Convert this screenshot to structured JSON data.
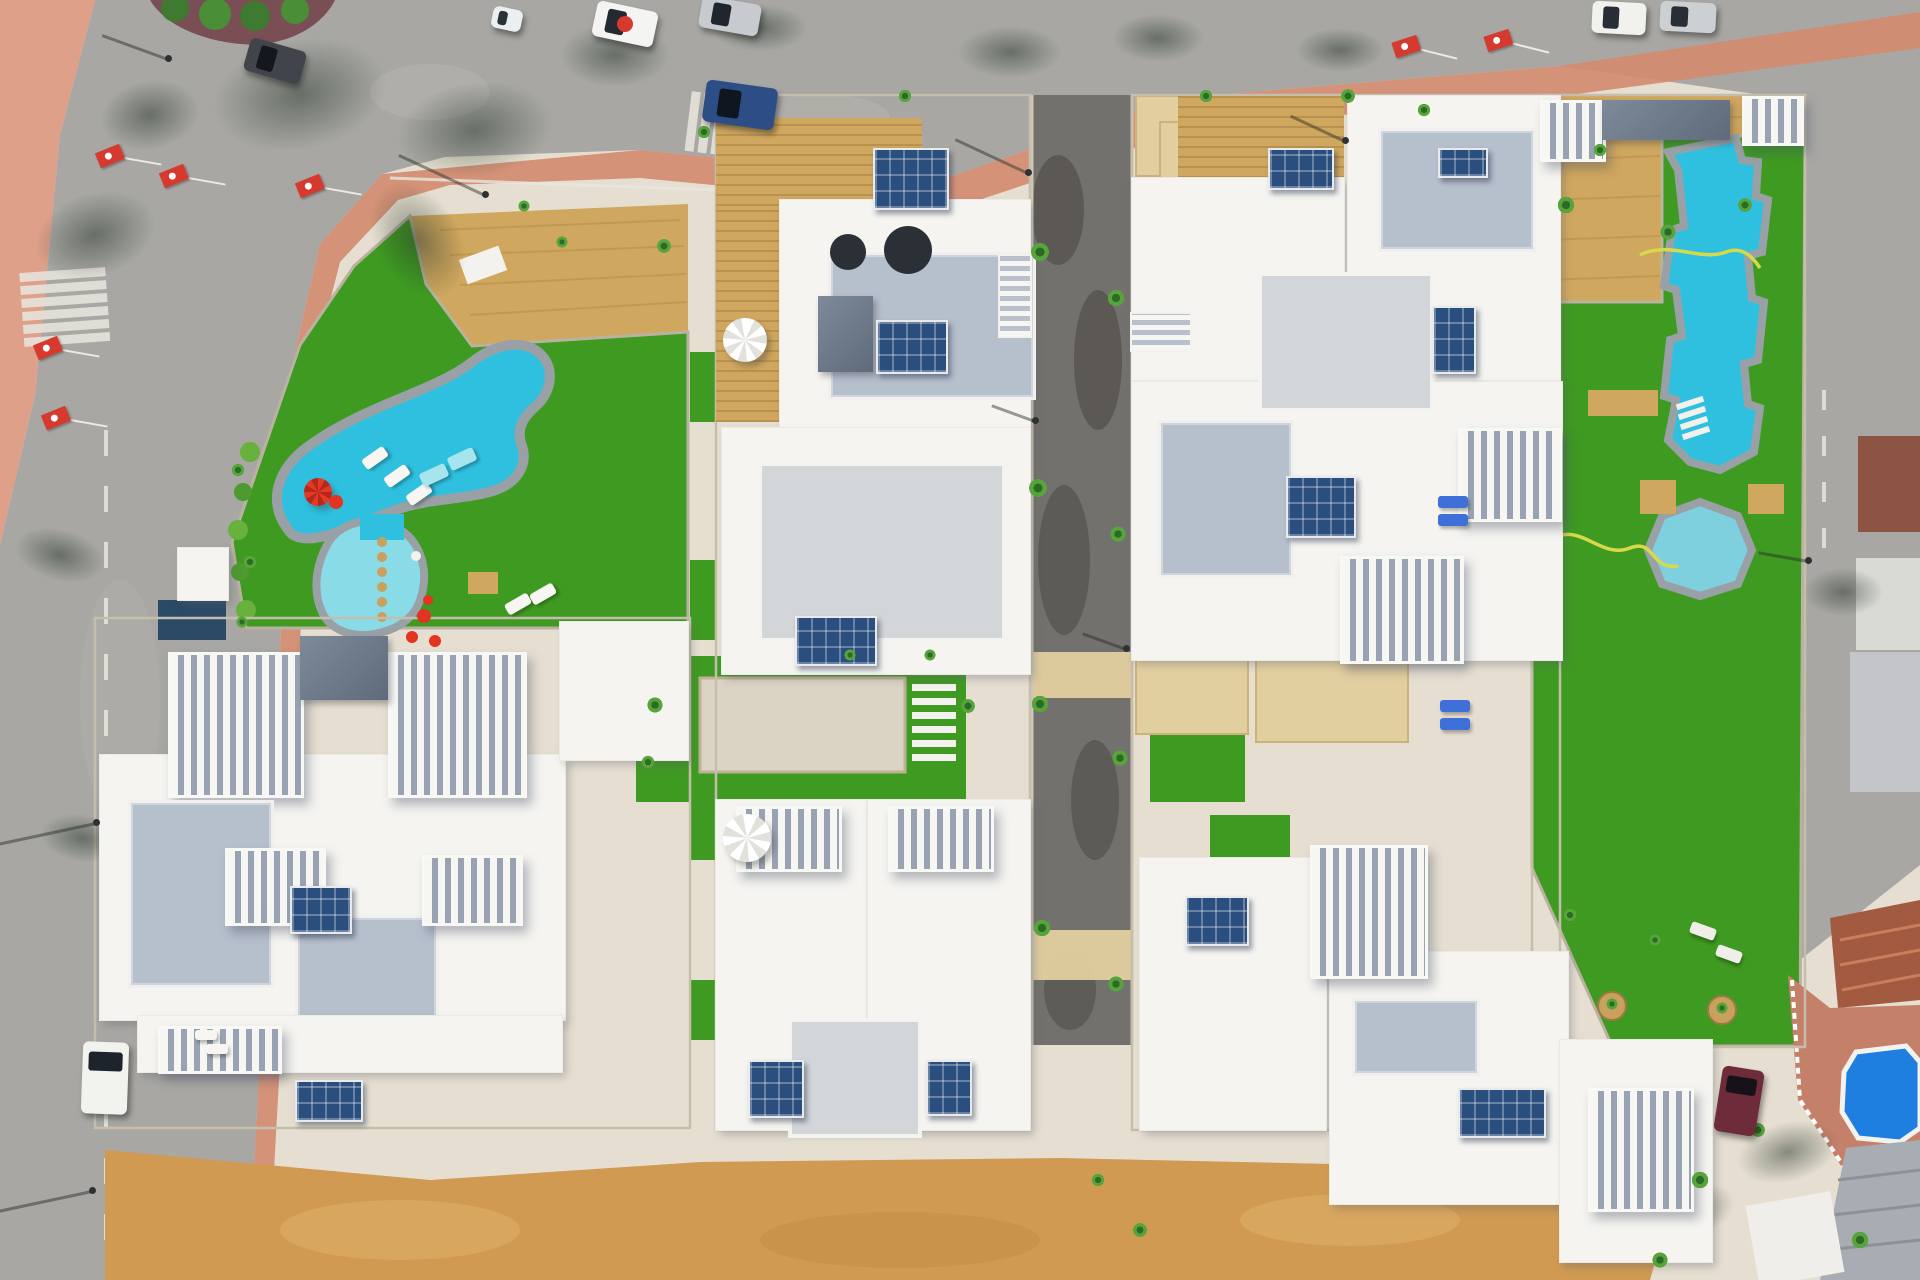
{
  "scene": {
    "kind": "aerial-drone-photo",
    "subject": "top-down aerial view of a new-build white villa residential complex with communal swimming pools, lawns, roads and parked cars",
    "colors": {
      "sand": "#e6dfd1",
      "plaza": "#dfa089",
      "sidewalk": "#d28b70",
      "terracepink": "#c5806a",
      "road": "#a8a7a3",
      "roadlight": "#b7b5b0",
      "roaddark": "#73716d",
      "roadblotch": "#56544f",
      "dirt": "#d09a52",
      "lawn": "#3f9a22",
      "deck": "#d0a75e",
      "pool": "#2fc0e0",
      "poolshallow": "#8adbe8",
      "spa": "#7fd0de",
      "smallpool": "#1e7fe0",
      "coping": "#99a1a6",
      "villa": "#f5f4f0",
      "terrace": "#b6bfcc",
      "tile": "#e2cfa0",
      "wall": "#c6beac",
      "hose": "#d8d94a",
      "flagred": "#d63a2e",
      "terracotta": "#a25a40",
      "brick": "#8a4a38",
      "metal": "#a7adb2",
      "navy": "#2a4a66"
    },
    "buildings_format": [
      "part",
      "x",
      "y",
      "w",
      "h"
    ],
    "buildings": [
      [
        "roof",
        100,
        755,
        465,
        265
      ],
      [
        "roof",
        560,
        622,
        128,
        138
      ],
      [
        "pergola",
        168,
        652,
        130,
        140
      ],
      [
        "pergola",
        388,
        652,
        133,
        140
      ],
      [
        "darkroof",
        300,
        636,
        88,
        64
      ],
      [
        "terrace",
        128,
        800,
        140,
        182
      ],
      [
        "terrace",
        295,
        915,
        138,
        100
      ],
      [
        "pergola",
        225,
        848,
        95,
        72
      ],
      [
        "pergola",
        422,
        855,
        95,
        65
      ],
      [
        "roof",
        138,
        1016,
        424,
        56
      ],
      [
        "pergola",
        158,
        1026,
        118,
        42
      ],
      [
        "roof",
        178,
        548,
        50,
        52
      ],
      [
        "wood",
        716,
        118,
        206,
        88
      ],
      [
        "wood",
        716,
        206,
        64,
        216
      ],
      [
        "roof",
        780,
        200,
        250,
        228
      ],
      [
        "terrace",
        828,
        252,
        202,
        142
      ],
      [
        "darkroof",
        818,
        296,
        55,
        76
      ],
      [
        "stairs",
        1000,
        256,
        30,
        80
      ],
      [
        "roof",
        722,
        428,
        308,
        246
      ],
      [
        "paleroof",
        758,
        462,
        240,
        172
      ],
      [
        "roof",
        716,
        800,
        150,
        330
      ],
      [
        "roof",
        868,
        800,
        162,
        330
      ],
      [
        "pergola",
        736,
        806,
        100,
        60
      ],
      [
        "pergola",
        888,
        806,
        100,
        60
      ],
      [
        "paleroof",
        788,
        1018,
        126,
        112
      ],
      [
        "wood",
        1178,
        96,
        166,
        82
      ],
      [
        "roof",
        1132,
        178,
        212,
        202
      ],
      [
        "roof",
        1348,
        96,
        212,
        284
      ],
      [
        "terrace",
        1378,
        128,
        152,
        118
      ],
      [
        "stairs",
        1132,
        314,
        58,
        36
      ],
      [
        "roof",
        1132,
        382,
        430,
        278
      ],
      [
        "paleroof",
        1258,
        272,
        168,
        132
      ],
      [
        "terrace",
        1158,
        420,
        130,
        152
      ],
      [
        "pergola",
        1340,
        556,
        118,
        102
      ],
      [
        "pergola",
        1458,
        428,
        98,
        88
      ],
      [
        "roof",
        1140,
        858,
        186,
        272
      ],
      [
        "roof",
        1330,
        952,
        238,
        252
      ],
      [
        "pergola",
        1310,
        845,
        112,
        128
      ],
      [
        "terrace",
        1352,
        998,
        122,
        72
      ],
      [
        "roof",
        1560,
        1040,
        152,
        222
      ],
      [
        "pergola",
        1588,
        1088,
        100,
        118
      ],
      [
        "pergola",
        1540,
        100,
        60,
        56
      ],
      [
        "darkroof",
        1602,
        100,
        128,
        40
      ],
      [
        "pergola",
        1742,
        96,
        56,
        44
      ]
    ],
    "solar_arrays_format": [
      "x",
      "y",
      "w",
      "h"
    ],
    "solar_arrays": [
      [
        873,
        148,
        72,
        58
      ],
      [
        876,
        320,
        68,
        50
      ],
      [
        795,
        616,
        78,
        46
      ],
      [
        748,
        1060,
        52,
        54
      ],
      [
        926,
        1060,
        42,
        52
      ],
      [
        290,
        886,
        58,
        44
      ],
      [
        295,
        1080,
        64,
        38
      ],
      [
        1268,
        148,
        62,
        38
      ],
      [
        1438,
        148,
        46,
        26
      ],
      [
        1432,
        306,
        40,
        64
      ],
      [
        1286,
        476,
        66,
        58
      ],
      [
        1185,
        896,
        60,
        46
      ],
      [
        1458,
        1088,
        84,
        46
      ]
    ],
    "cars": [
      {
        "x": 594,
        "y": 6,
        "w": 62,
        "h": 36,
        "rot": 12,
        "body": "#f4f4f2",
        "win": "#232a31",
        "dot": "#d63a2e"
      },
      {
        "x": 700,
        "y": 0,
        "w": 60,
        "h": 32,
        "rot": 10,
        "body": "#c7cbd0",
        "win": "#1f262d"
      },
      {
        "x": 246,
        "y": 44,
        "w": 58,
        "h": 34,
        "rot": 16,
        "body": "#41454b",
        "win": "#14181d"
      },
      {
        "x": 492,
        "y": 8,
        "w": 30,
        "h": 22,
        "rot": 12,
        "body": "#eceff1",
        "win": "#2a3138"
      },
      {
        "x": 704,
        "y": 84,
        "w": 72,
        "h": 42,
        "rot": 8,
        "body": "#2c4d86",
        "win": "#10161f"
      },
      {
        "x": 1592,
        "y": 2,
        "w": 54,
        "h": 32,
        "rot": 3,
        "body": "#f1f1ee",
        "win": "#272e35"
      },
      {
        "x": 1660,
        "y": 2,
        "w": 56,
        "h": 30,
        "rot": 3,
        "body": "#cdd0d3",
        "win": "#272e35"
      },
      {
        "x": 82,
        "y": 1042,
        "w": 46,
        "h": 72,
        "rot": 2,
        "body": "#f2f2ef",
        "win": "#1d242c",
        "vert": true
      },
      {
        "x": 1718,
        "y": 1068,
        "w": 42,
        "h": 66,
        "rot": 9,
        "body": "#6e2b3a",
        "win": "#171219",
        "vert": true
      }
    ],
    "flags_format": [
      "x",
      "y",
      "rot"
    ],
    "flags": [
      [
        100,
        140,
        -22
      ],
      [
        164,
        160,
        -22
      ],
      [
        300,
        170,
        -22
      ],
      [
        38,
        332,
        -22
      ],
      [
        46,
        402,
        -22
      ],
      [
        1396,
        32,
        -18
      ],
      [
        1488,
        26,
        -18
      ]
    ],
    "palms_format": [
      "x",
      "y",
      "r"
    ],
    "palms": [
      [
        1040,
        252,
        13
      ],
      [
        1116,
        298,
        12
      ],
      [
        1038,
        488,
        13
      ],
      [
        1118,
        534,
        11
      ],
      [
        1040,
        704,
        12
      ],
      [
        1120,
        758,
        11
      ],
      [
        1042,
        928,
        12
      ],
      [
        1116,
        984,
        11
      ],
      [
        655,
        705,
        11
      ],
      [
        648,
        762,
        9
      ],
      [
        968,
        706,
        10
      ],
      [
        238,
        470,
        9
      ],
      [
        250,
        562,
        9
      ],
      [
        242,
        622,
        8
      ],
      [
        1348,
        96,
        10
      ],
      [
        1424,
        110,
        9
      ],
      [
        664,
        246,
        10
      ],
      [
        704,
        132,
        9
      ],
      [
        1206,
        96,
        9
      ],
      [
        524,
        206,
        8
      ],
      [
        562,
        242,
        8
      ],
      [
        905,
        96,
        9
      ],
      [
        850,
        655,
        8
      ],
      [
        930,
        655,
        8
      ],
      [
        1566,
        205,
        12
      ],
      [
        1668,
        232,
        11
      ],
      [
        1745,
        205,
        10
      ],
      [
        1600,
        150,
        9
      ],
      [
        1612,
        1004,
        8
      ],
      [
        1722,
        1008,
        8
      ],
      [
        1570,
        915,
        9
      ],
      [
        1655,
        940,
        8
      ],
      [
        1700,
        1180,
        12
      ],
      [
        1758,
        1130,
        10
      ],
      [
        1860,
        1240,
        12
      ],
      [
        1660,
        1260,
        11
      ],
      [
        1140,
        1230,
        10
      ],
      [
        1098,
        1180,
        9
      ]
    ],
    "tree_shadows_format": [
      "cx",
      "cy",
      "rx",
      "ry",
      "rot"
    ],
    "tree_shadows": [
      [
        300,
        95,
        88,
        55,
        -12
      ],
      [
        475,
        130,
        78,
        48,
        -8
      ],
      [
        615,
        55,
        55,
        32,
        0
      ],
      [
        760,
        28,
        48,
        24,
        0
      ],
      [
        1010,
        52,
        52,
        26,
        0
      ],
      [
        1158,
        38,
        46,
        24,
        0
      ],
      [
        1340,
        50,
        44,
        22,
        0
      ],
      [
        95,
        235,
        62,
        42,
        -18
      ],
      [
        150,
        115,
        50,
        35,
        -10
      ],
      [
        60,
        555,
        46,
        26,
        15
      ],
      [
        82,
        838,
        42,
        24,
        8
      ],
      [
        418,
        240,
        42,
        62,
        -30
      ],
      [
        1843,
        592,
        40,
        24,
        0
      ],
      [
        1788,
        1152,
        52,
        30,
        -15
      ],
      [
        1690,
        1212,
        46,
        26,
        -18
      ]
    ],
    "lamps_format": [
      "x",
      "y",
      "shadow_len",
      "shadow_angle_deg"
    ],
    "lamps": [
      [
        485,
        194,
        95,
        205
      ],
      [
        1028,
        172,
        80,
        205
      ],
      [
        96,
        822,
        120,
        168
      ],
      [
        92,
        1190,
        120,
        168
      ],
      [
        168,
        58,
        70,
        200
      ],
      [
        1035,
        420,
        46,
        200
      ],
      [
        1126,
        648,
        46,
        200
      ],
      [
        1345,
        140,
        60,
        205
      ],
      [
        1808,
        560,
        50,
        190
      ]
    ],
    "loungers_format": [
      "x",
      "y",
      "rot",
      "w",
      "h",
      "color"
    ],
    "loungers": [
      [
        362,
        452,
        -35,
        26,
        12,
        "#f7f6f2"
      ],
      [
        384,
        470,
        -35,
        26,
        12,
        "#f7f6f2"
      ],
      [
        406,
        488,
        -35,
        26,
        12,
        "#f7f6f2"
      ],
      [
        505,
        598,
        -30,
        26,
        12,
        "#f7f6f2"
      ],
      [
        530,
        588,
        -30,
        26,
        12,
        "#f7f6f2"
      ],
      [
        420,
        468,
        -25,
        28,
        14,
        "#a6e4ee"
      ],
      [
        448,
        452,
        -25,
        28,
        14,
        "#a6e4ee"
      ],
      [
        1438,
        496,
        0,
        30,
        12,
        "#3f6fd8"
      ],
      [
        1438,
        514,
        0,
        30,
        12,
        "#3f6fd8"
      ],
      [
        1440,
        700,
        0,
        30,
        12,
        "#3f6fd8"
      ],
      [
        1440,
        718,
        0,
        30,
        12,
        "#3f6fd8"
      ],
      [
        1690,
        925,
        20,
        26,
        12,
        "#efeee9"
      ],
      [
        1716,
        948,
        20,
        26,
        12,
        "#efeee9"
      ],
      [
        195,
        1030,
        0,
        22,
        10,
        "#f7f6f2"
      ],
      [
        206,
        1044,
        0,
        22,
        10,
        "#f7f6f2"
      ]
    ],
    "parasols_format": [
      "x",
      "y",
      "r",
      "style"
    ],
    "parasols": [
      [
        745,
        340,
        22,
        "white"
      ],
      [
        747,
        838,
        24,
        "white"
      ],
      [
        318,
        492,
        14,
        "red"
      ]
    ],
    "accents_format": [
      "x",
      "y",
      "r",
      "color"
    ],
    "accents": [
      [
        336,
        502,
        7,
        "#e23420"
      ],
      [
        424,
        616,
        7,
        "#e23420"
      ],
      [
        435,
        641,
        6,
        "#e23420"
      ],
      [
        412,
        637,
        6,
        "#e23420"
      ],
      [
        428,
        600,
        5,
        "#e23420"
      ],
      [
        416,
        556,
        5,
        "#f5f2ea"
      ],
      [
        848,
        252,
        18,
        "#2b2f36"
      ],
      [
        908,
        250,
        24,
        "#2b2f36"
      ]
    ]
  }
}
